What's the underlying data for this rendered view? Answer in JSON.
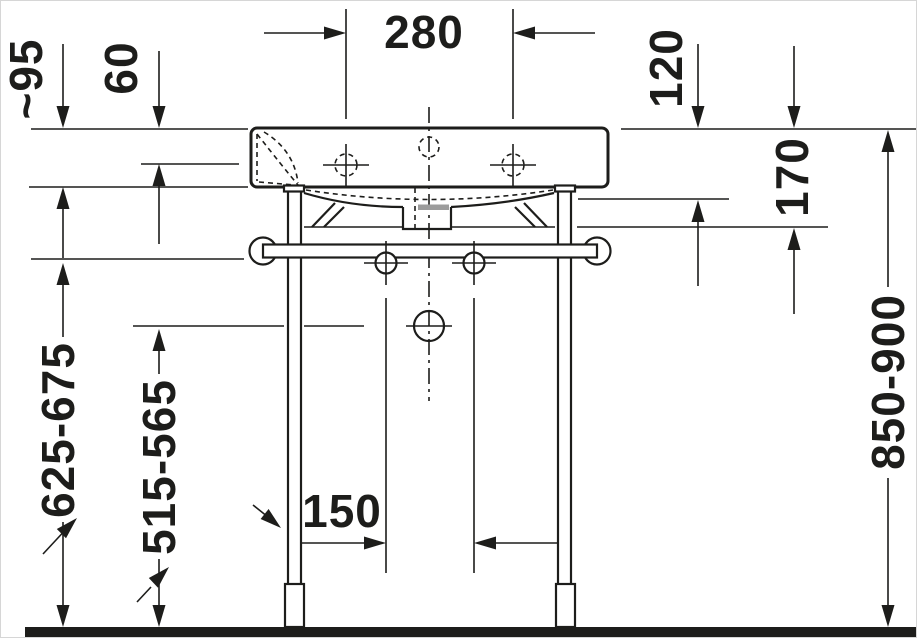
{
  "colors": {
    "line": "#1d1d1b",
    "shading": "#9c9c9c",
    "background": "#ffffff"
  },
  "dimensions": {
    "tap_hole_distance": "280",
    "rim_front_drop_approx": "~95",
    "rim_depth": "60",
    "rim_to_underside": "120",
    "rim_to_trap_bottom": "170",
    "overall_height_range": "850-900",
    "rail_height_range": "625-675",
    "drain_height_range": "515-565",
    "leg_to_fixing_offset": "150"
  }
}
